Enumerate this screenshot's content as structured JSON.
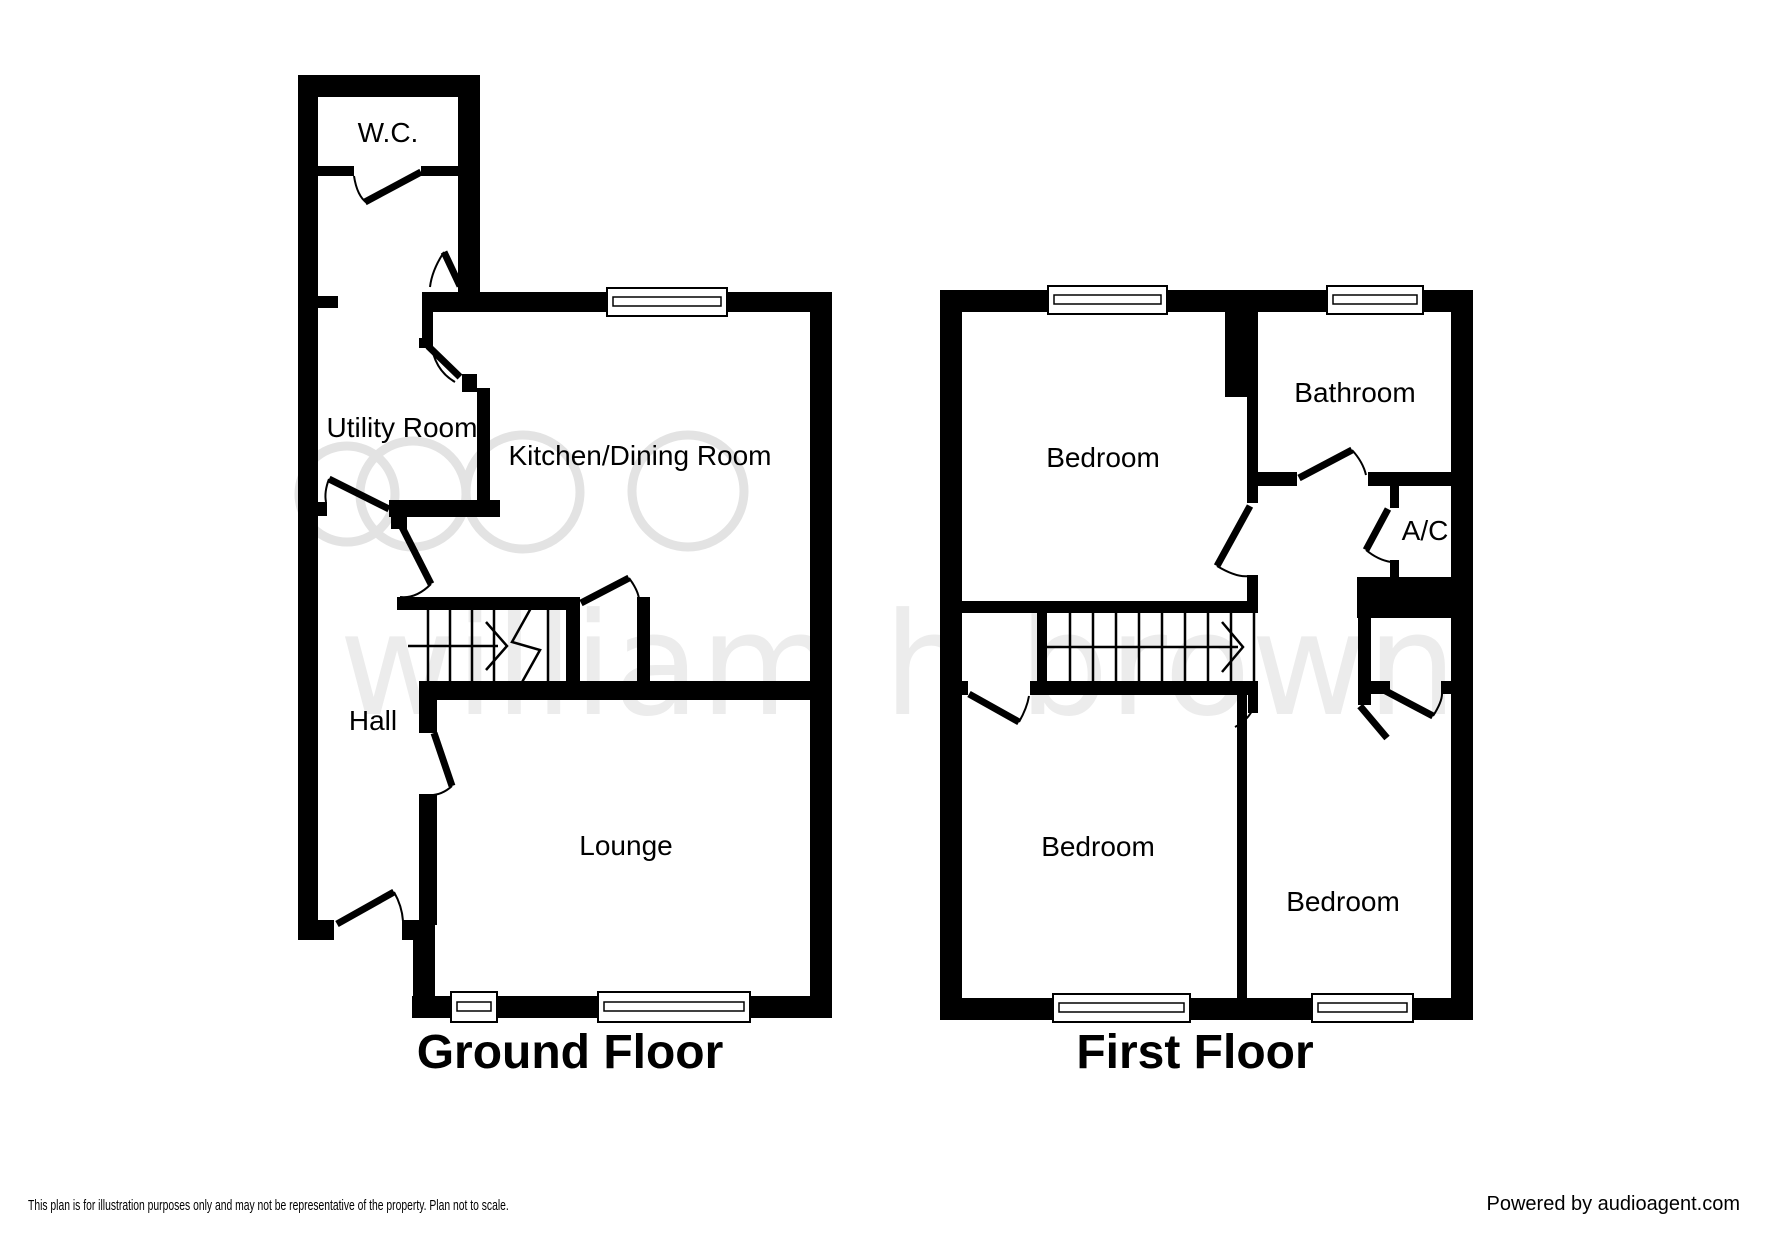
{
  "watermark": {
    "logo_text": "william h brown"
  },
  "ground_floor": {
    "title": "Ground Floor",
    "rooms": {
      "wc": "W.C.",
      "utility": "Utility Room",
      "kitchen": "Kitchen/Dining Room",
      "hall": "Hall",
      "lounge": "Lounge"
    }
  },
  "first_floor": {
    "title": "First Floor",
    "rooms": {
      "bedroom_front": "Bedroom",
      "bathroom": "Bathroom",
      "ac": "A/C",
      "bedroom_back": "Bedroom",
      "bedroom_small": "Bedroom"
    }
  },
  "footer": {
    "disclaimer": "This plan is for illustration purposes only and may not be representative of the property. Plan not to scale.",
    "credit": "Powered by audioagent.com"
  },
  "colors": {
    "wall": "#000000",
    "watermark": "#e9e9e9",
    "background": "#ffffff"
  }
}
